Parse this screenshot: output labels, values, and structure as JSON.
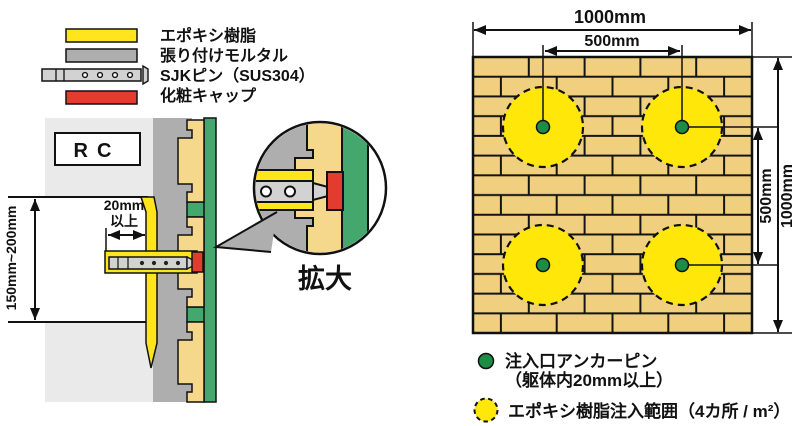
{
  "colors": {
    "epoxy_yellow": "#ffe41e",
    "injection_yellow": "#ffe70a",
    "mortar_gray": "#aeaeae",
    "pin_gray": "#d2d2d2",
    "cap_red": "#e23c2e",
    "tile_tan": "#f5d88c",
    "finish_green": "#44a86e",
    "rc_gray": "#eaeaea",
    "brick_tan": "#f0d07e",
    "brick_joint": "#141414",
    "pin_dot_green": "#1d8c45",
    "white": "#ffffff"
  },
  "legend": {
    "items": [
      {
        "label": "エポキシ樹脂"
      },
      {
        "label": "張り付けモルタル"
      },
      {
        "label": "SJKピン（SUS304）"
      },
      {
        "label": "化粧キャップ"
      }
    ]
  },
  "section": {
    "rc_label": "RC",
    "embed_depth_value": "20mm",
    "embed_depth_suffix": "以上",
    "pitch_range": "150mm~200mm",
    "magnifier_label": "拡大"
  },
  "elevation": {
    "total_width": "1000mm",
    "pin_spacing_h": "500mm",
    "pin_spacing_v": "500mm",
    "total_height": "1000mm"
  },
  "notes": {
    "anchor_pin_line1": "注入口アンカーピン",
    "anchor_pin_line2": "（躯体内20mm以上）",
    "epoxy_range": "エポキシ樹脂注入範囲（4カ所 / m²）"
  }
}
